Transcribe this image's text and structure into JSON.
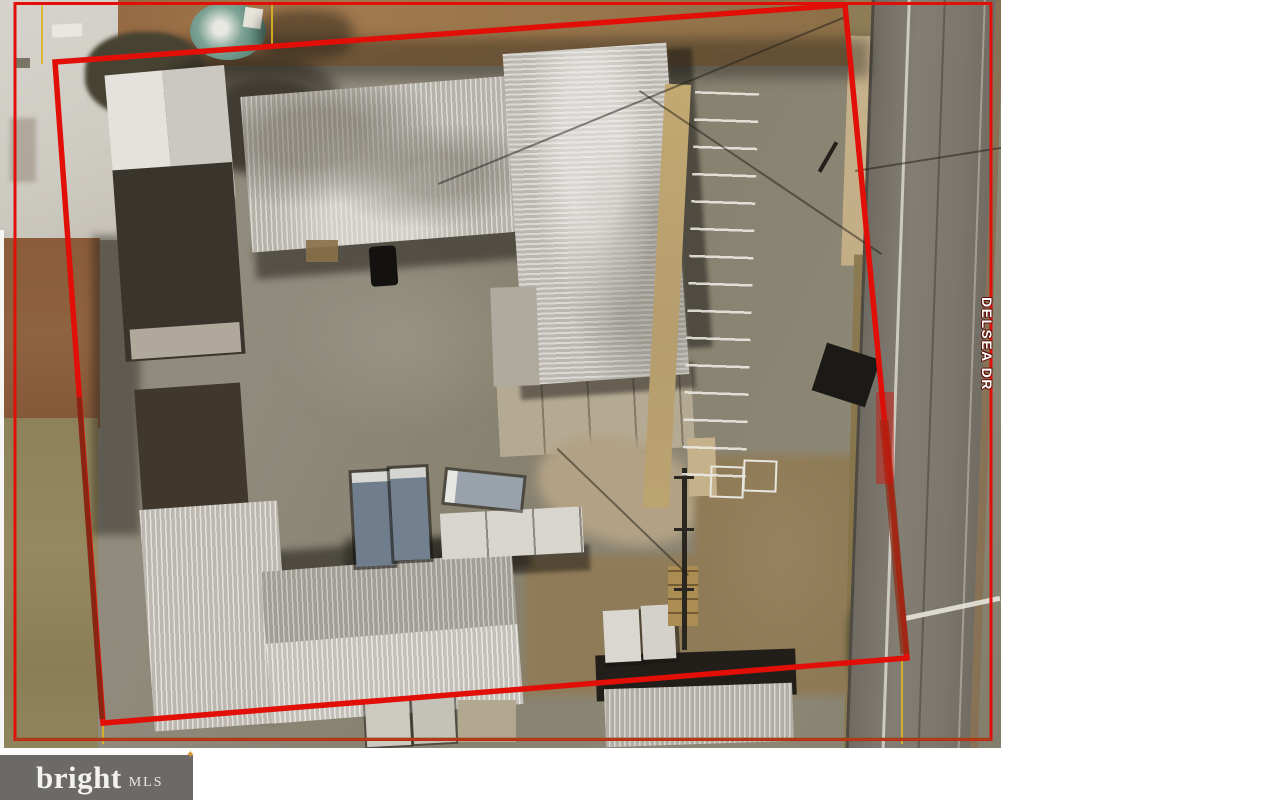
{
  "map": {
    "street_label": "DELSEA DR"
  },
  "watermark": {
    "brand": "bright",
    "suffix": "MLS",
    "sparkle": "✦"
  },
  "colors": {
    "boundary_red": "#e10f08",
    "boundary_dark_red": "#7c2a15",
    "parcel_yellow": "#ddb425",
    "logo_bg": "#6b6a66",
    "logo_text": "#f3f2ee",
    "sparkle_gold": "#d8952f"
  }
}
